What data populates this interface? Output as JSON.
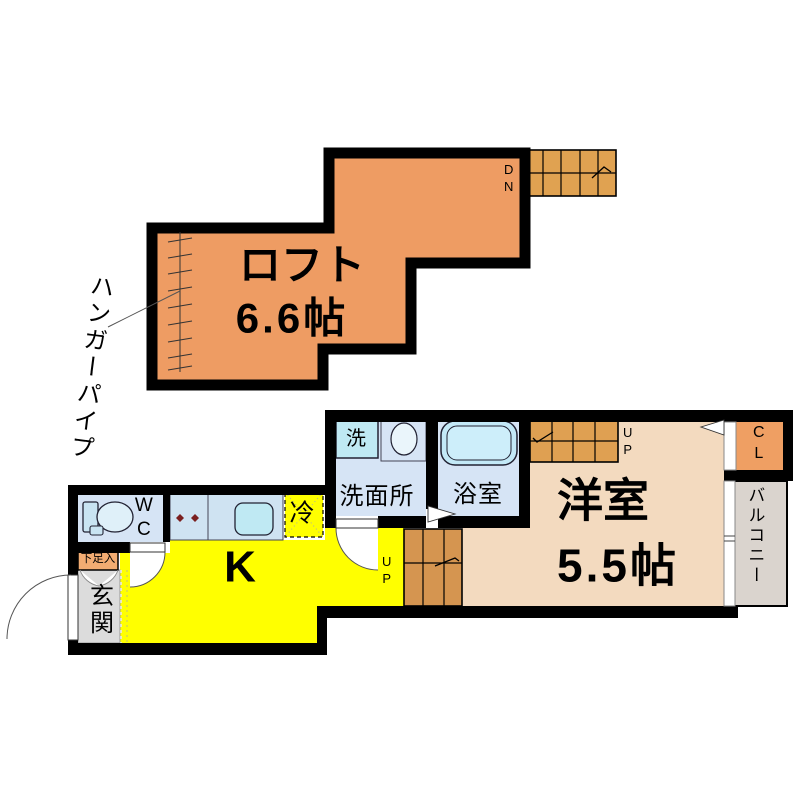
{
  "colors": {
    "wall": "#000000",
    "loft_fill": "#EE9C63",
    "loft_stairs_fill": "#E0A251",
    "upper_stairs_fill": "#DFA052",
    "lower_stairs_fill": "#D59550",
    "western_room_fill": "#F3DABF",
    "kitchen_fill": "#FFFF00",
    "water_area_fill": "#D6E4F5",
    "counter_fill": "#CFE3F2",
    "fixture_cyan": "#BFE9F3",
    "closet_fill": "#EF9F63",
    "shoe_cabinet_fill": "#F2AC72",
    "entrance_fill": "#DCDCDC",
    "balcony_fill": "#DAD4CE",
    "burner_color": "#7A1F1F"
  },
  "loft_floor": {
    "room_label": "ロフト",
    "room_size": "6.6帖",
    "stairs_label": "DN",
    "hanger_pipe_label": "ハンガーパイプ"
  },
  "main_floor": {
    "western_room_label": "洋室",
    "western_room_size": "5.5帖",
    "kitchen_label": "K",
    "refrigerator_label": "冷",
    "toilet_label": "WC",
    "washroom_label": "洗面所",
    "washing_machine_label": "洗",
    "bathroom_label": "浴室",
    "stairs_label": "UP",
    "closet_label": "CL",
    "balcony_label": "バルコニー",
    "entrance_label": "玄関",
    "shoe_cabinet_label": "下足入"
  }
}
